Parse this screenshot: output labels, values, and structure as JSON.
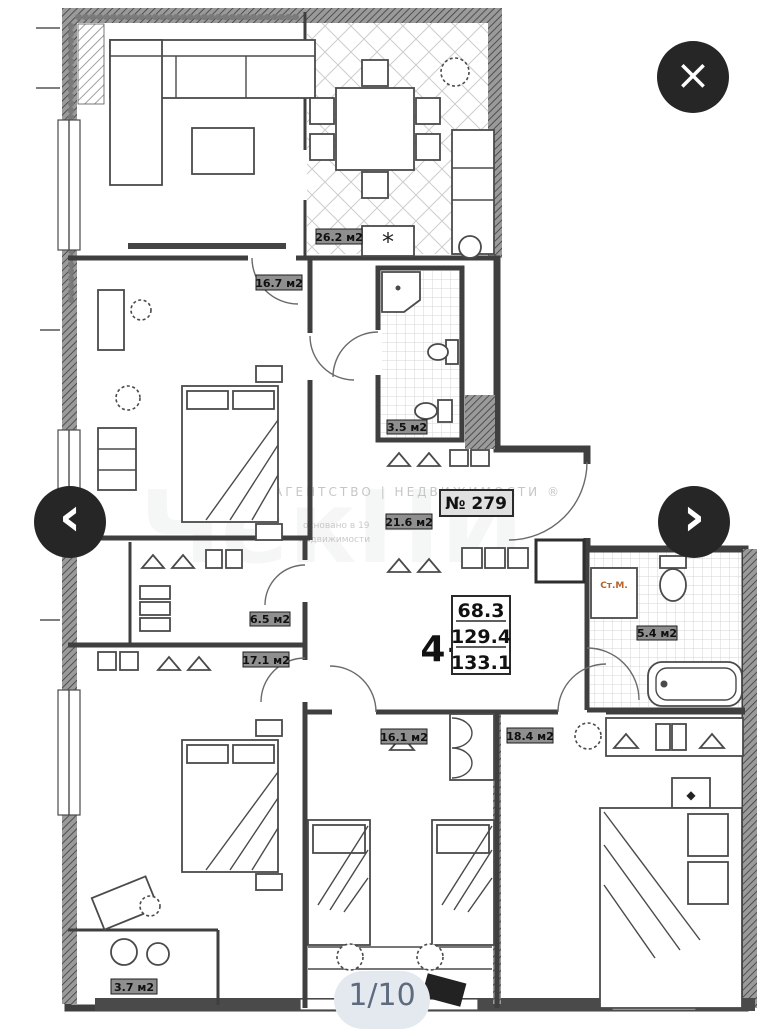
{
  "viewer": {
    "counter": "1/10"
  },
  "icons": {
    "close": "×",
    "prev": "‹",
    "next": "›",
    "stove": "*",
    "star": "◆"
  },
  "colors": {
    "button_bg": "#262626",
    "counter_bg": "#e4e9f0",
    "counter_text": "#5e6b7e",
    "washer_label": "#b5642a",
    "plan_line": "#3f3f3f"
  },
  "floorplan": {
    "unit": {
      "number": "№ 279",
      "type": "4+",
      "living_area": "68.3",
      "area": "129.4",
      "total_area": "133.1"
    },
    "rooms": {
      "kitchen_living": "26.2 м2",
      "bedroom1": "16.7 м2",
      "bathroom1": "3.5 м2",
      "hall": "21.6 м2",
      "wardrobe": "6.5 м2",
      "bedroom2": "17.1 м2",
      "bedroom3": "16.1 м2",
      "bedroom4": "18.4 м2",
      "bathroom2": "5.4 м2",
      "storage": "3.7 м2",
      "washing_machine": "Ст.М."
    },
    "watermark": {
      "agency": "АГЕНТСТВО  |  НЕДВИЖИМОСТИ ®",
      "logo": "ЧекНИ",
      "line1": "основано в 19",
      "line2": "недвижимости"
    }
  }
}
